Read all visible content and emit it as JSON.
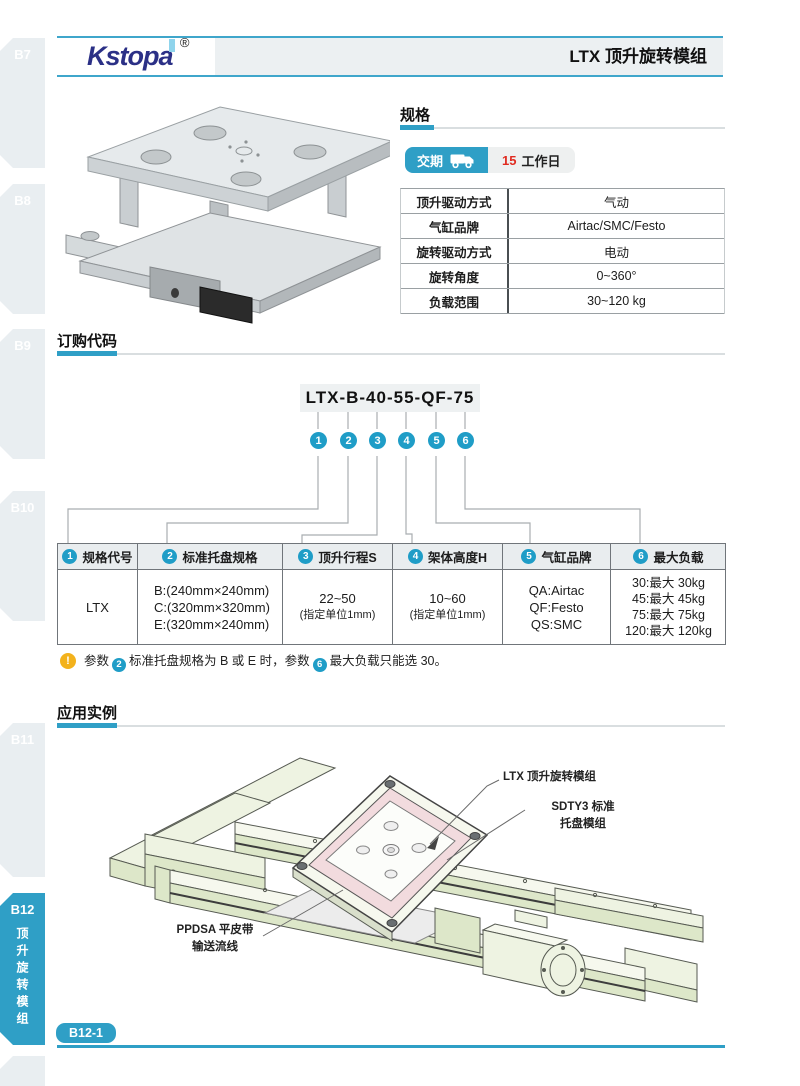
{
  "header": {
    "logo_text": "Kstopa",
    "registered_mark": "®",
    "title": "LTX 顶升旋转模组"
  },
  "sidebar": {
    "tabs": [
      {
        "label": "B7"
      },
      {
        "label": "B8"
      },
      {
        "label": "B9"
      },
      {
        "label": "B10"
      },
      {
        "label": "B11"
      }
    ],
    "active_tab": {
      "label": "B12",
      "vertical_label": "顶升旋转模组"
    }
  },
  "specs": {
    "section_title": "规格",
    "delivery": {
      "label": "交期",
      "icon": "truck-icon",
      "days": "15",
      "unit": "工作日"
    },
    "rows": [
      {
        "label": "顶升驱动方式",
        "value": "气动"
      },
      {
        "label": "气缸品牌",
        "value": "Airtac/SMC/Festo"
      },
      {
        "label": "旋转驱动方式",
        "value": "电动"
      },
      {
        "label": "旋转角度",
        "value": "0~360°"
      },
      {
        "label": "负载范围",
        "value": "30~120 kg"
      }
    ]
  },
  "ordering": {
    "section_title": "订购代码",
    "code": "LTX-B-40-55-QF-75",
    "callouts": [
      "1",
      "2",
      "3",
      "4",
      "5",
      "6"
    ],
    "columns": [
      {
        "num": "1",
        "label": "规格代号"
      },
      {
        "num": "2",
        "label": "标准托盘规格"
      },
      {
        "num": "3",
        "label": "顶升行程S"
      },
      {
        "num": "4",
        "label": "架体高度H"
      },
      {
        "num": "5",
        "label": "气缸品牌"
      },
      {
        "num": "6",
        "label": "最大负载"
      }
    ],
    "row": {
      "spec_code": "LTX",
      "pallet_options": [
        "B:(240mm×240mm)",
        "C:(320mm×320mm)",
        "E:(320mm×240mm)"
      ],
      "stroke_main": "22~50",
      "stroke_sub": "(指定单位1mm)",
      "height_main": "10~60",
      "height_sub": "(指定单位1mm)",
      "cylinder_options": [
        "QA:Airtac",
        "QF:Festo",
        "QS:SMC"
      ],
      "load_options": [
        "30:最大 30kg",
        "45:最大 45kg",
        "75:最大 75kg",
        "120:最大 120kg"
      ]
    },
    "note": {
      "part1": "参数",
      "circle1": "2",
      "part2": "标准托盘规格为 B 或 E 时，参数",
      "circle2": "6",
      "part3": "最大负载只能选 30。"
    }
  },
  "application": {
    "section_title": "应用实例",
    "labels": {
      "module": "LTX 顶升旋转模组",
      "pallet_line1": "SDTY3 标准",
      "pallet_line2": "托盘模组",
      "belt_line1": "PPDSA 平皮带",
      "belt_line2": "输送流线"
    }
  },
  "footer": {
    "page_badge": "B12-1"
  },
  "colors": {
    "accent_blue": "#2f9fc6",
    "logo_navy": "#2b3086",
    "logo_light_blue": "#8fd4ec",
    "days_red": "#e02b20",
    "note_yellow": "#f3b21c",
    "drawing_green": "#e9efdb",
    "pallet_pink": "#f2dbde",
    "header_bg": "#ecf0f2"
  }
}
